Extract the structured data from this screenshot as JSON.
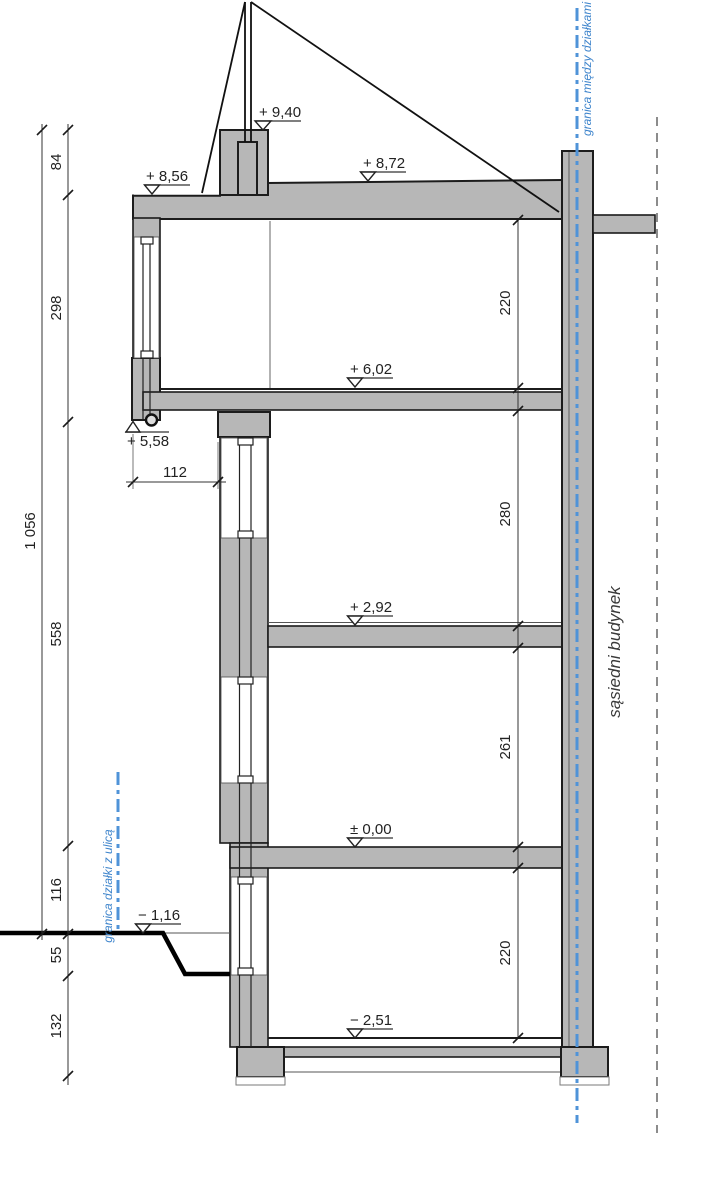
{
  "colors": {
    "background": "#ffffff",
    "wall_gray": "#b7b7b7",
    "outline": "#1c1c1c",
    "boundary_blue": "#4f93d8",
    "dashed_gray": "#8c8c8c"
  },
  "dims": {
    "total": "1 056",
    "left": [
      "84",
      "298",
      "558",
      "116",
      "55",
      "132"
    ],
    "right": [
      "220",
      "280",
      "261",
      "220"
    ],
    "width": "112"
  },
  "levels": {
    "attic_top": "+ 9,40",
    "roof_left": "+ 8,56",
    "roof_right": "+ 8,72",
    "floor_2": "+ 6,02",
    "soffit": "+ 5,58",
    "floor_1": "+ 2,92",
    "ground_floor": "± 0,00",
    "street": "− 1,16",
    "basement": "− 2,51"
  },
  "labels": {
    "plot_boundary": "granica między działkami",
    "street_boundary": "granica działki z ulicą",
    "neighbor": "sąsiedni budynek"
  }
}
